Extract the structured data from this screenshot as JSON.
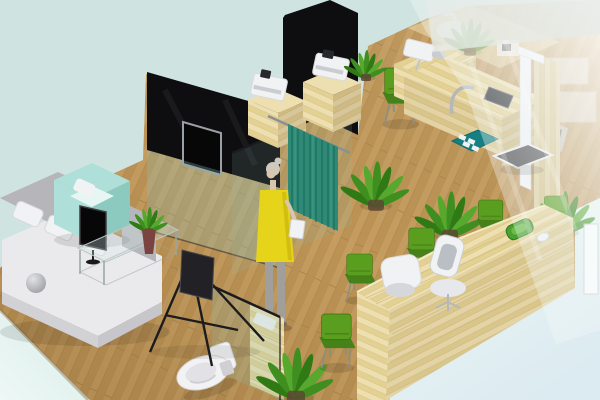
{
  "meta": {
    "description": "3D isometric rendering of a clinic interior with lounge, consultation room, exam room, restroom and reception waiting area",
    "width": 600,
    "height": 400
  },
  "palette": {
    "background": "#cfe4e1",
    "corner_light": "#eef8f6",
    "corner_mid": "#d9ece9",
    "corner_blue": "#dcebf1",
    "floor_plank_a": "#c59d60",
    "floor_plank_b": "#bc9355",
    "floor_seam": "#a9854b",
    "desk_plank_a": "#eedfb0",
    "desk_plank_b": "#e3d194",
    "desk_seam": "#d2bc7e",
    "desk_shade": "#c8ad6f",
    "wall_black": "#0e0e10",
    "tv_screen": "#070708",
    "tv_frame": "#9aa0a5",
    "glass_tint": "#8fbdb2",
    "glass_edge": "#1b1b1f",
    "curtain": "#2e8a76",
    "curtain_dark": "#1d6b59",
    "curtain_light": "#4aa58c",
    "rail_gray": "#8a9094",
    "chair_green": "#5a9e1f",
    "chair_green_dark": "#47811a",
    "chair_leg": "#8a8f84",
    "sofa_white": "#eaeaec",
    "sofa_gray": "#b5b5ba",
    "sofa_shade": "#d2d2d6",
    "armchair_mint": "#aedfd8",
    "armchair_mint_dark": "#8ccabf",
    "armchair_mint_light": "#e8f6f3",
    "dress_yellow": "#e6d41a",
    "hair_gray": "#cfc9bd",
    "skin": "#d9c6ae",
    "legs_gray": "#a19f9c",
    "device_white": "#f1f2f4",
    "device_gray": "#c9ccd0",
    "screen_dark": "#26282c",
    "plant_green_a": "#3e8f1f",
    "plant_green_b": "#2f7a14",
    "plant_green_c": "#57a92e",
    "pot_brown": "#5a4632",
    "toilet_white": "#f2f2f4",
    "toilet_shade": "#cfcfd4",
    "platform_dark": "#47474b",
    "mat_teal": "#157f82",
    "tray_green": "#49a033",
    "vase_maroon": "#7a4340",
    "easel_black": "#1c1c1e",
    "haze_white": "#ffffff",
    "frost_white": "#e6ebe8",
    "mullion_white": "#fafcfc"
  },
  "scene": {
    "areas": [
      {
        "id": "lounge-area",
        "objects": [
          "sectional-sofa",
          "mint-armchair",
          "glass-coffee-table",
          "table-plant",
          "monitor-on-stand",
          "floor-easel-stand",
          "dome-lamp"
        ]
      },
      {
        "id": "media-wall",
        "objects": [
          "black-partition-wall",
          "wall-tv",
          "glass-panel"
        ]
      },
      {
        "id": "consultation-room",
        "objects": [
          "privacy-curtain",
          "curtain-rail",
          "standing-person",
          "clipboard",
          "potted-plant",
          "potted-plant",
          "glass-divider"
        ]
      },
      {
        "id": "equipment-bay",
        "objects": [
          "black-partition-wall",
          "wood-cabinet",
          "printer-device",
          "wood-cabinet",
          "printer-device",
          "potted-plant"
        ]
      },
      {
        "id": "exam-room",
        "objects": [
          "exam-desk",
          "blood-pressure-monitor",
          "tablet-device",
          "support-arc",
          "floor-mat",
          "green-chair",
          "stadiometer",
          "weighing-platform",
          "wood-column",
          "hazy-plant"
        ]
      },
      {
        "id": "wash-area",
        "objects": [
          "frosted-glass-panel",
          "counter",
          "sink",
          "faucet",
          "shelf-boxes",
          "laptop-device"
        ]
      },
      {
        "id": "restroom",
        "objects": [
          "toilet",
          "glass-panel",
          "wood-shelf",
          "towel",
          "potted-plant"
        ]
      },
      {
        "id": "reception-area",
        "objects": [
          "reception-counter",
          "cube-chair",
          "office-chair",
          "green-chair",
          "green-chair",
          "green-chair",
          "green-chair",
          "green-chair",
          "desk-tray",
          "computer-mouse",
          "potted-plant"
        ]
      },
      {
        "id": "glass-wall",
        "objects": [
          "glass-overlay",
          "white-mullion"
        ]
      }
    ]
  }
}
